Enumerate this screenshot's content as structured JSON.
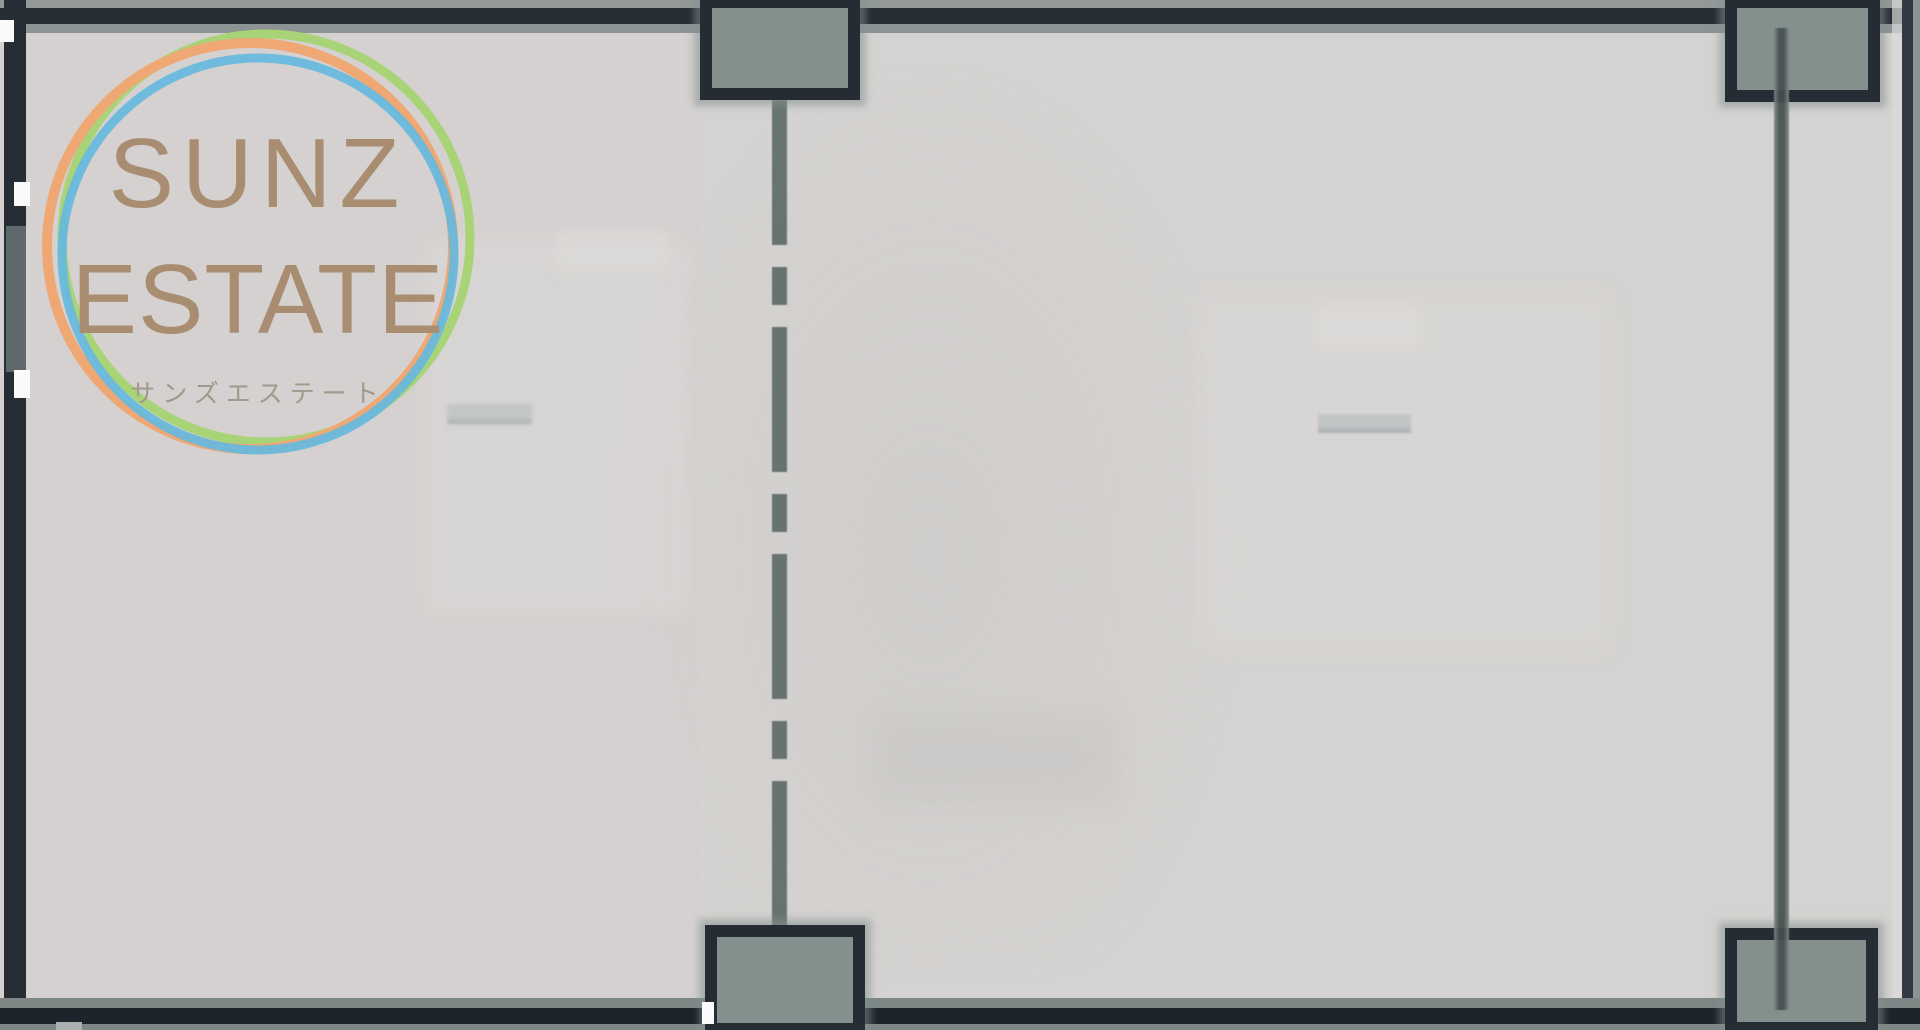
{
  "logo": {
    "line1": "SUNZ",
    "line2": "ESTATE",
    "kana": "サンズエステート",
    "text_color": "#a98d71",
    "kana_color": "#a2988b",
    "ring_colors": {
      "orange": "#efa873",
      "green": "#a9d377",
      "blue": "#66b9de"
    }
  },
  "floorplan": {
    "description_colors": {
      "floor": "#d5d3d1",
      "wall_dark": "#272d35",
      "wall_gray": "#8b9394",
      "column_fill": "#84908e",
      "centerline_dash": "#5f6c6a"
    },
    "columns": [
      "top-left",
      "top-right",
      "bottom-left",
      "bottom-right"
    ],
    "lines": [
      "center-dashed-guideline",
      "right-solid-wall-line"
    ]
  },
  "theme": {
    "floor": "#d5d3d1",
    "wall-dark": "#272d35",
    "wall-darker": "#1d242c",
    "wall-gray": "#8b9394",
    "wall-gray2": "#7c8786",
    "col-fill": "#84908e",
    "col-border": "#252c34",
    "dash-color": "#5f6c6a",
    "line-edge": "#7f8b89",
    "line-core": "#454f4e",
    "win-gray": "#5d696b",
    "logo-tan": "#a98d71",
    "logo-kana": "#a2988b",
    "ring-orange": "#efa873",
    "ring-green": "#a9d377",
    "ring-blue": "#66b9de"
  }
}
